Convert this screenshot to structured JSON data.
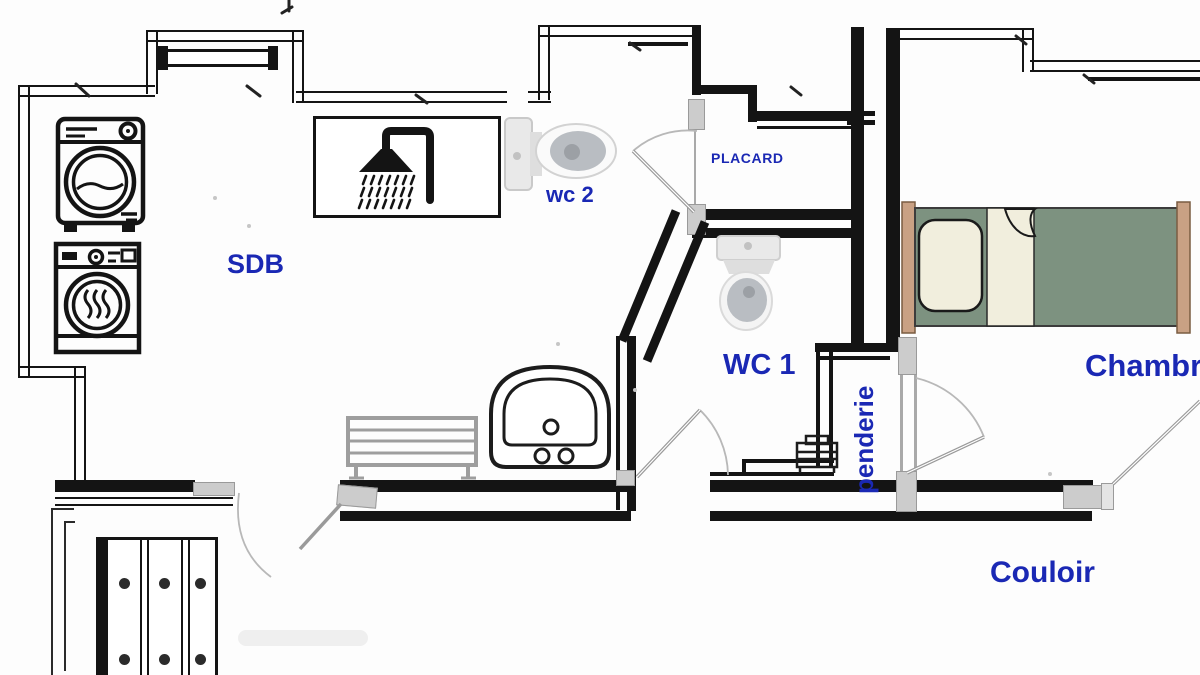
{
  "plan": {
    "type": "architectural-floor-plan",
    "labels": {
      "sdb": "SDB",
      "wc2": "wc 2",
      "placard": "PLACARD",
      "wc1": "WC 1",
      "penderie": "penderie",
      "chambre": "Chambre",
      "couloir": "Couloir"
    },
    "colors": {
      "label_blue": "#1a28b4",
      "wall": "#141414",
      "jamb_gray": "#cccccc",
      "door_stroke": "#9a9a9a",
      "arc_stroke": "#b8b8b8",
      "fixture_gray": "#ebebeb",
      "fixture_inner_gray": "#b9bdc2",
      "bed_green": "#7d9280",
      "bed_wood": "#c9a184",
      "linen_cream": "#f1eedd",
      "radiator_gray": "#9e9e9e"
    },
    "fixtures": [
      {
        "name": "washing-machine"
      },
      {
        "name": "dryer"
      },
      {
        "name": "shower"
      },
      {
        "name": "toilet-wc2"
      },
      {
        "name": "toilet-wc1"
      },
      {
        "name": "washbasin"
      },
      {
        "name": "towel-radiator"
      },
      {
        "name": "single-bed"
      },
      {
        "name": "wardrobe"
      },
      {
        "name": "shelf-unit"
      }
    ]
  }
}
